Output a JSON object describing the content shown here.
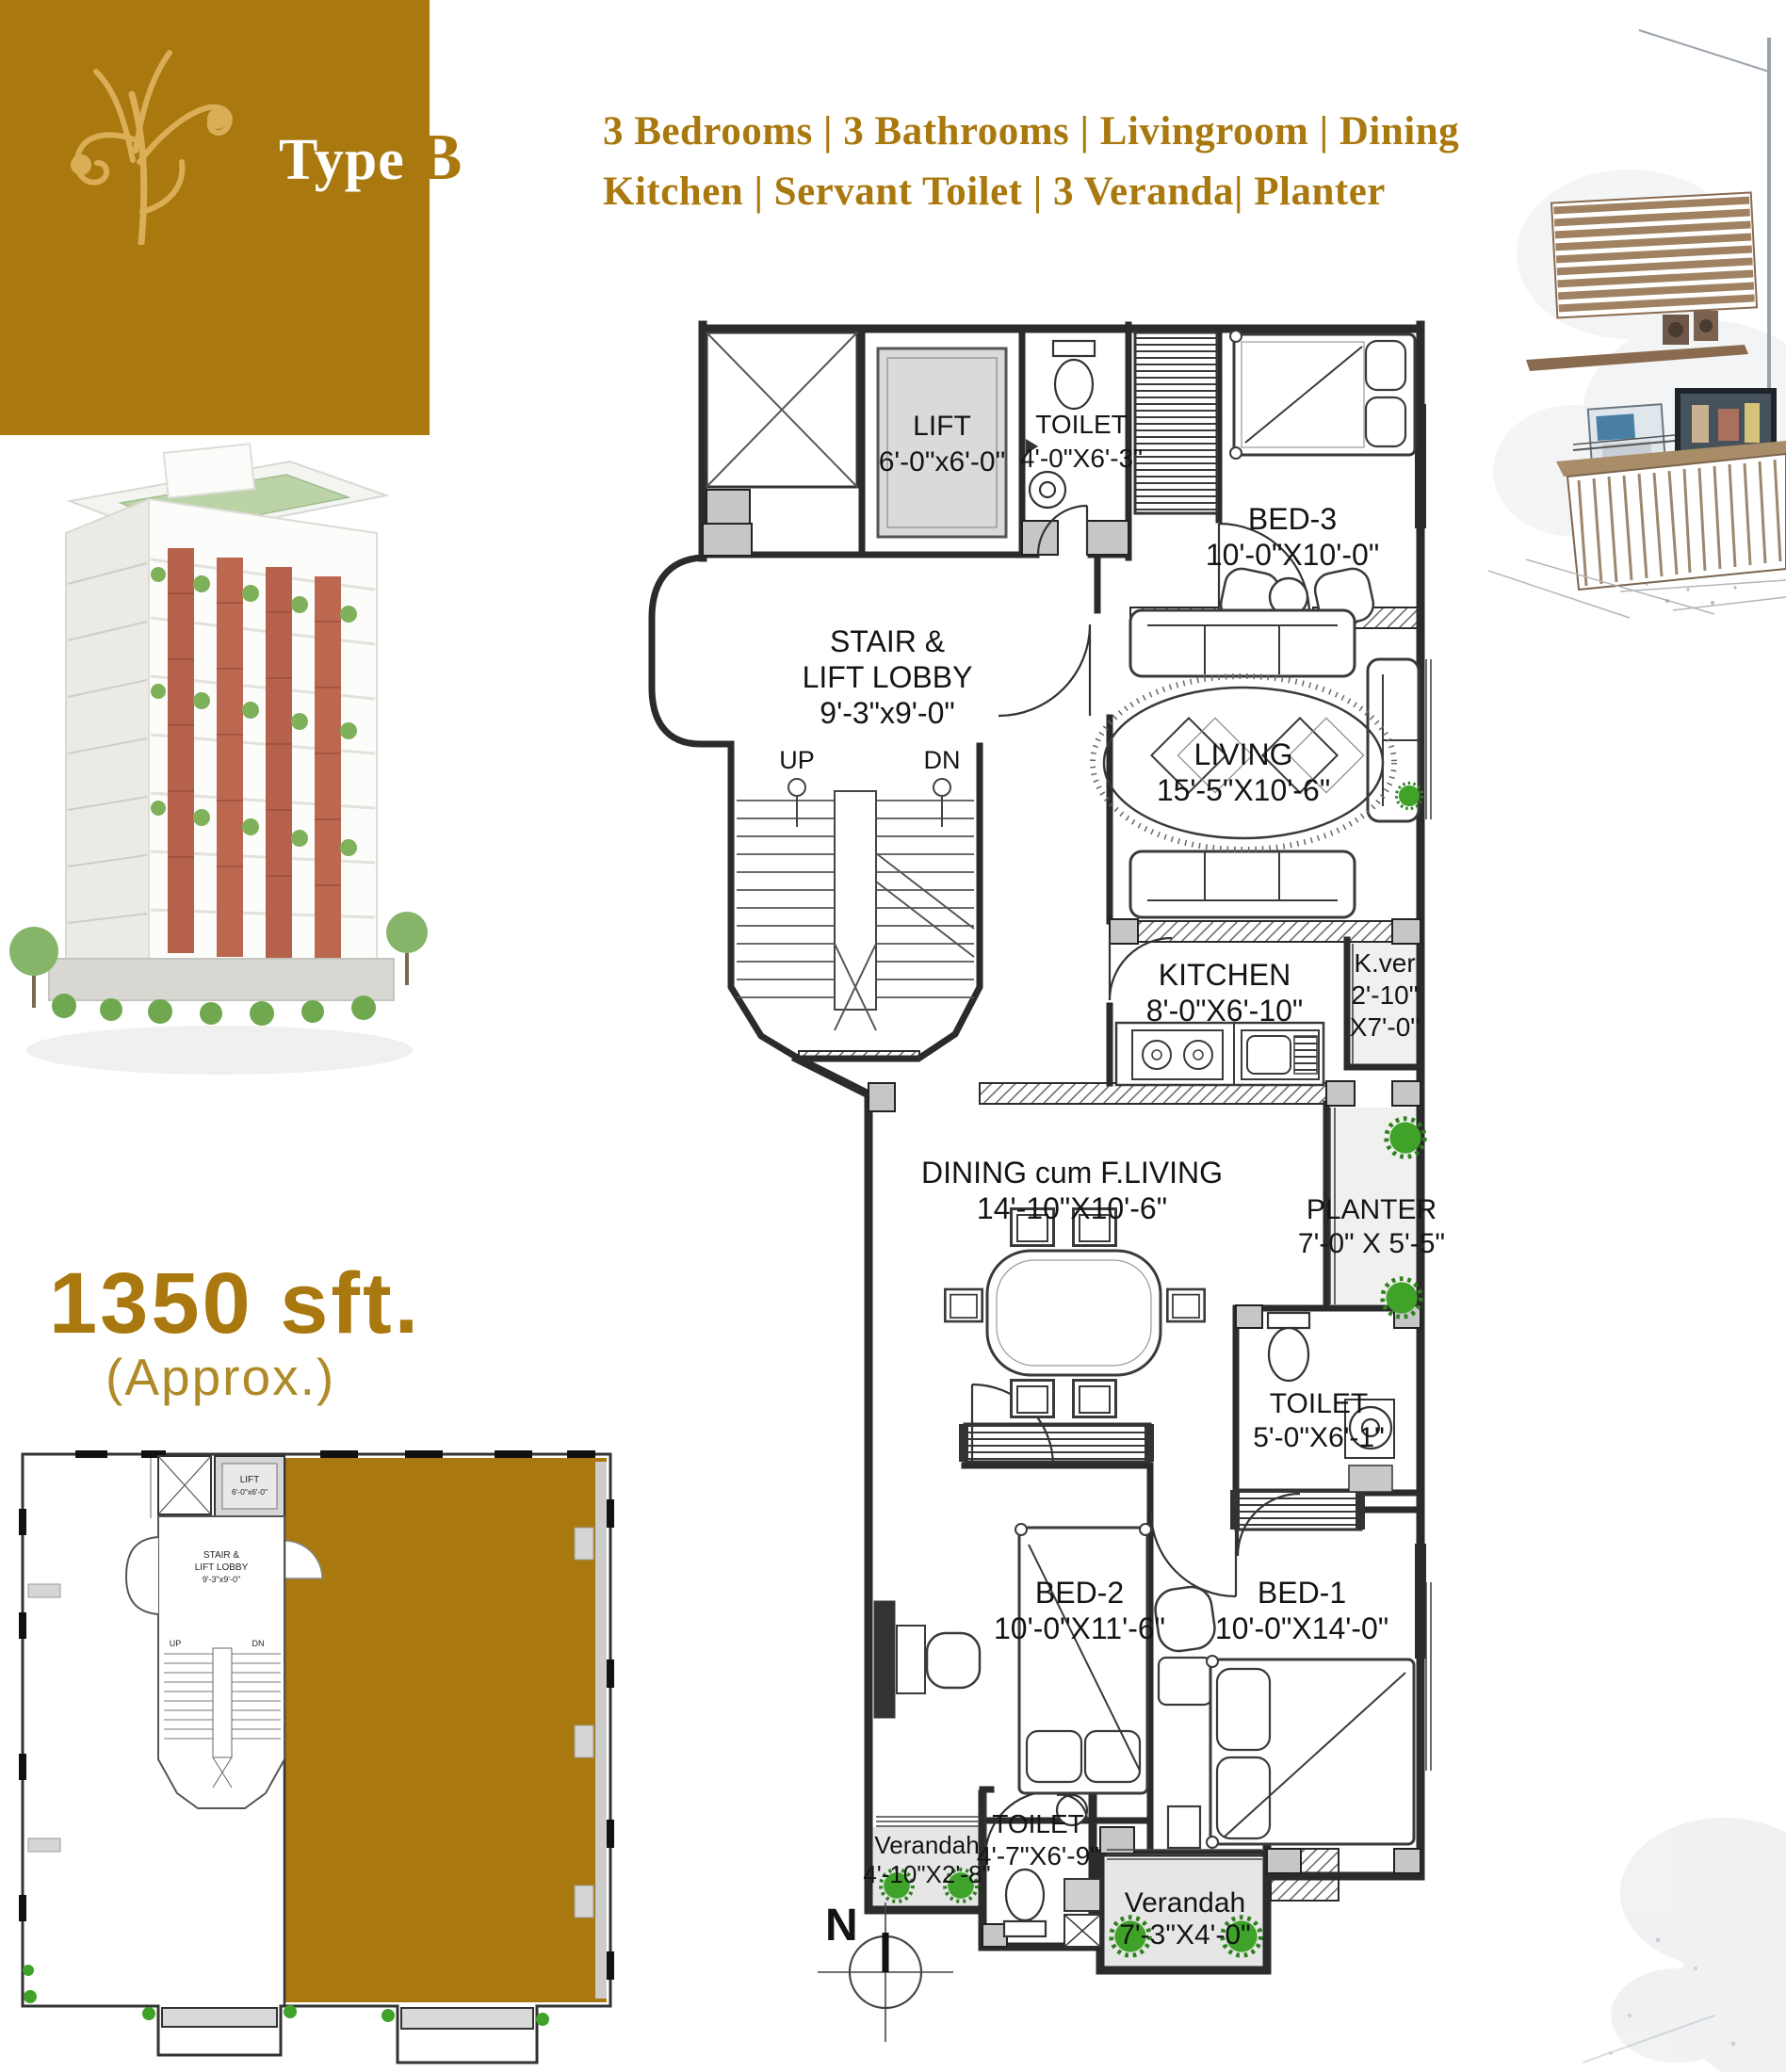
{
  "page": {
    "type_word": "Type",
    "type_letter": "B",
    "header_line1": "3 Bedrooms | 3 Bathrooms  | Livingroom | Dining",
    "header_line2": "Kitchen  | Servant  Toilet | 3 Veranda| Planter",
    "area_value": "1350 sft.",
    "area_note": "(Approx.)",
    "north_label": "N"
  },
  "colors": {
    "gold": "#A9780E",
    "gold_light": "#D9AE57",
    "wall_dark": "#2B2B2B",
    "floor_gray": "#E6E6E6",
    "bush_green": "#3FA32A"
  },
  "plan": {
    "lift": {
      "name": "LIFT",
      "dims": "6'-0\"x6'-0\""
    },
    "toilet_top": {
      "name": "TOILET",
      "dims": "4'-0\"X6'-3\""
    },
    "bed3": {
      "name": "BED-3",
      "dims": "10'-0\"X10'-0\""
    },
    "lobby": {
      "name1": "STAIR &",
      "name2": "LIFT LOBBY",
      "dims": "9'-3\"x9'-0\""
    },
    "stair_up": "UP",
    "stair_dn": "DN",
    "living": {
      "name": "LIVING",
      "dims": "15'-5\"X10'-6\""
    },
    "kitchen": {
      "name": "KITCHEN",
      "dims": "8'-0\"X6'-10\""
    },
    "kver": {
      "name": "K.ver",
      "dims1": "2'-10\"",
      "dims2": "X7'-0\""
    },
    "dining": {
      "name": "DINING cum F.LIVING",
      "dims": "14'-10\"X10'-6\""
    },
    "planter": {
      "name": "PLANTER",
      "dims": "7'-0\" X 5'-5\""
    },
    "toilet_mid": {
      "name": "TOILET",
      "dims": "5'-0\"X6'-1\""
    },
    "bed2": {
      "name": "BED-2",
      "dims": "10'-0\"X11'-6\""
    },
    "bed1": {
      "name": "BED-1",
      "dims": "10'-0\"X14'-0\""
    },
    "toilet_bottom": {
      "name": "TOILET",
      "dims": "4'-7\"X6'-9\""
    },
    "verandah_left": {
      "name": "Verandah",
      "dims": "4'-10\"X2'-8\""
    },
    "verandah_right": {
      "name": "Verandah",
      "dims": "7'-3\"X4'-0\""
    }
  },
  "key_plan": {
    "lift_name": "LIFT",
    "lift_dims": "6'-0\"x6'-0\"",
    "lobby1": "STAIR &",
    "lobby2": "LIFT LOBBY",
    "lobby3": "9'-3\"x9'-0\"",
    "up": "UP",
    "dn": "DN"
  }
}
